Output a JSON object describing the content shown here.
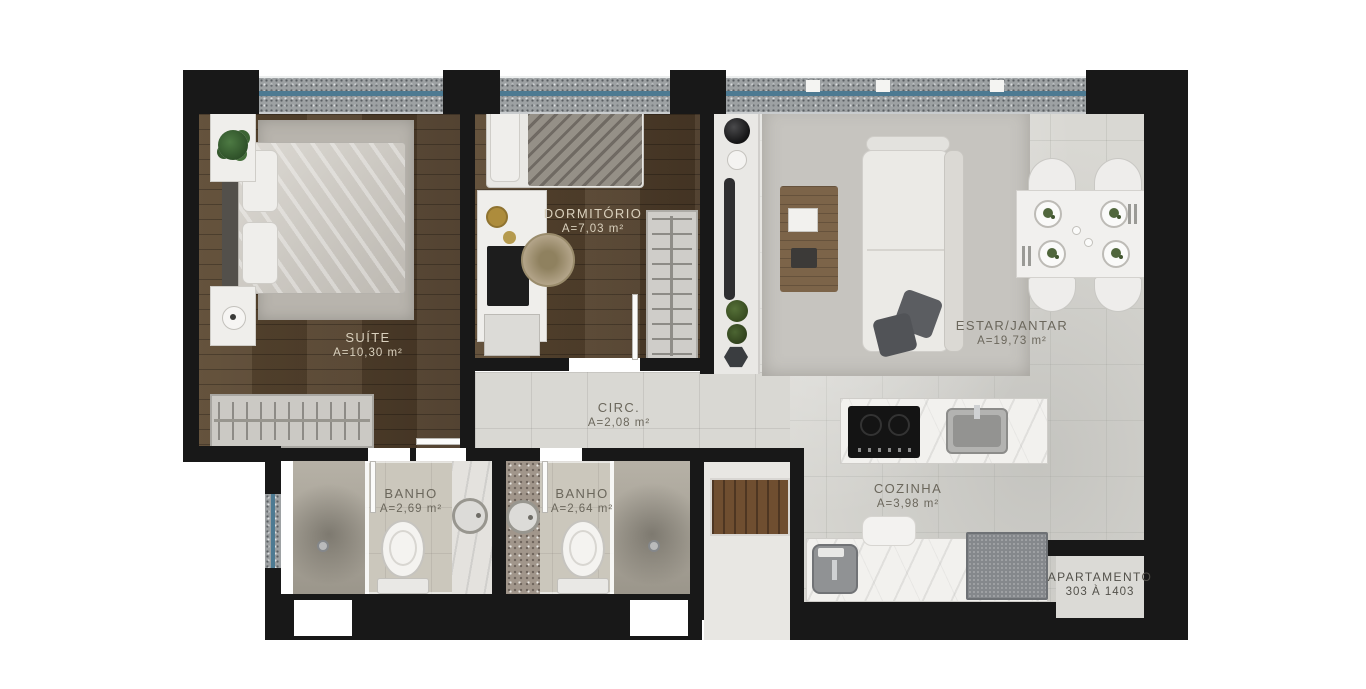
{
  "plan": {
    "rooms": [
      {
        "name": "SUÍTE",
        "area": "A=10,30 m²"
      },
      {
        "name": "DORMITÓRIO",
        "area": "A=7,03 m²"
      },
      {
        "name": "ESTAR/JANTAR",
        "area": "A=19,73 m²"
      },
      {
        "name": "CIRC.",
        "area": "A=2,08 m²"
      },
      {
        "name": "BANHO",
        "area": "A=2,69 m²"
      },
      {
        "name": "BANHO",
        "area": "A=2,64 m²"
      },
      {
        "name": "COZINHA",
        "area": "A=3,98 m²"
      }
    ],
    "apartment": {
      "line1": "APARTAMENTO",
      "line2": "303 À 1403"
    },
    "palette": {
      "wall": "#181818",
      "wood": "#56432e",
      "tile": "#d9d8d3",
      "glass": "#4d7a92",
      "rug": "#b8b4ad"
    }
  }
}
